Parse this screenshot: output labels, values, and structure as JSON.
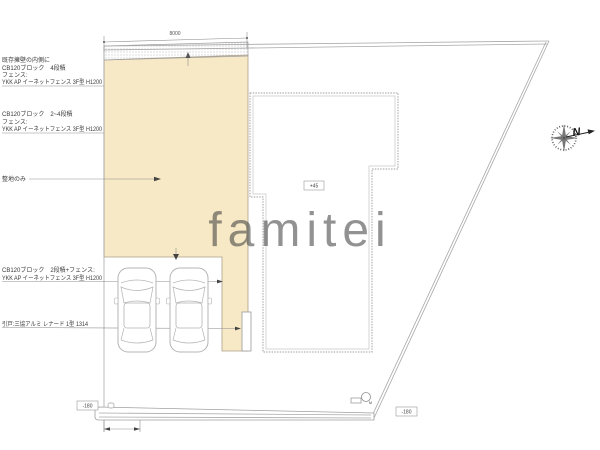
{
  "drawing": {
    "watermark": "famitei",
    "compass_north": "N",
    "dim_top": "8000",
    "levels": {
      "building": "+45",
      "road_left": "-180",
      "road_right": "-180"
    },
    "utility_label": "M",
    "annotations": {
      "a1": {
        "lines": [
          "既存擁壁の内側に",
          "CB120ブロック　4段積",
          "フェンス:",
          "YKK AP イーネットフェンス 3F型 H1200"
        ]
      },
      "a2": {
        "lines": [
          "CB120ブロック　2~4段積",
          "フェンス:",
          "YKK AP イーネットフェンス 3F型 H1200"
        ]
      },
      "a3": {
        "lines": [
          "整地のみ"
        ]
      },
      "a4": {
        "lines": [
          "CB120ブロック　2段積+フェンス:",
          "YKK AP イーネットフェンス 3F型 H1200"
        ]
      },
      "a5": {
        "lines": [
          "引戸:三協アルミ レナード 1型 1314"
        ]
      }
    }
  },
  "colors": {
    "parcel_fill": "#f7e9c5",
    "line_gray": "#a8a8a8",
    "watermark_gray": "#d6d6d6",
    "annotation_text": "#3a3a3a"
  }
}
